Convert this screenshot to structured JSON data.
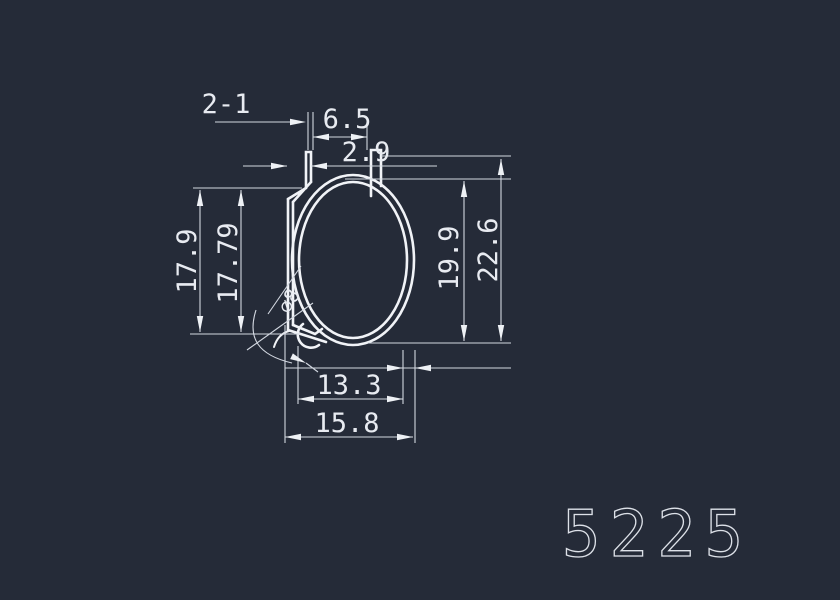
{
  "app": {
    "background_color": "#252b38",
    "profile_line_color": "#f1f3f7",
    "dimension_line_color": "#d3d8e1"
  },
  "drawing": {
    "part_number": "5225",
    "callout": "2-1",
    "dims": {
      "top_opening": "6.5",
      "prong_width": "2.9",
      "left_height_outer": "17.9",
      "left_height_inner": "17.79",
      "right_height_inner": "19.9",
      "right_height_outer": "22.6",
      "bottom_width_inner": "13.3",
      "bottom_width_outer": "15.8",
      "diameter_note": "∅8"
    }
  }
}
